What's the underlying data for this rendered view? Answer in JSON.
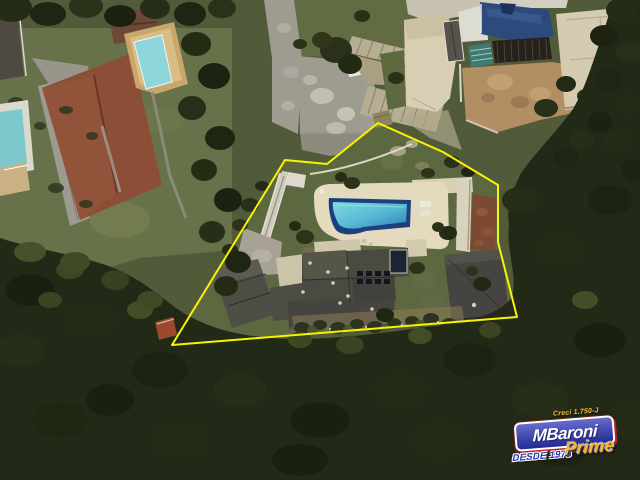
{
  "scene": {
    "type": "satellite-aerial-view",
    "description": "Aerial satellite photo of a residential estate; the listed lot (house, garage and swimming pool) is outlined in yellow, surrounded by neighboring houses, pools and dense forest.",
    "boundary": {
      "points": "285,160 327,164 378,123 443,152 498,185 498,242 517,317 172,345",
      "color": "#f8f400"
    },
    "colors": {
      "ground_base": "#515b39",
      "forest": "#222916",
      "lawn": "#5c6840",
      "pool_deck": "#e4dabd",
      "pool_navy": "#1d3f7e",
      "pool_water_light": "#7fd9de",
      "pool_water_mid": "#55b8d4",
      "pool_water_deep": "#2f7cb0",
      "roof_gray": "#4a4a43",
      "roof_terracotta": "#8c4e36",
      "neighbor_pool_light": "#8fd6da",
      "neighbor_pool_dark": "#2d4a7c",
      "pavement": "#9e9c91",
      "dirt": "#b28f62"
    }
  },
  "watermark": {
    "creci": "Creci 1.750-J",
    "brand": "MBaroni",
    "since": "DESDE 1975",
    "sub_brand": "Prime",
    "colors": {
      "box_blue": "#2a34b8",
      "red": "#c52020",
      "creci_yellow": "#f2c43a",
      "since_blue": "#2a35b5",
      "prime_gold": "#f0b82c"
    }
  }
}
